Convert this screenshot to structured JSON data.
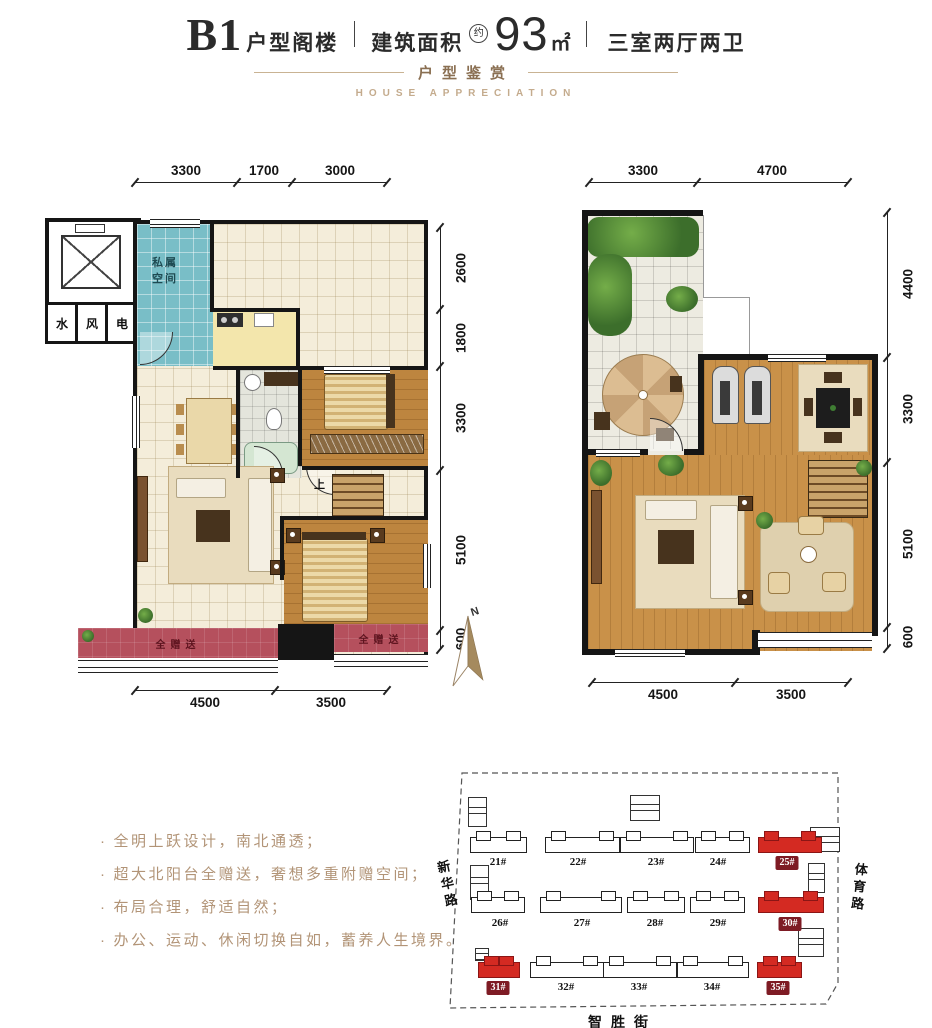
{
  "header": {
    "model": "B1",
    "model_suffix": "户型阁楼",
    "sep": "|",
    "area_label": "建筑面积",
    "approx": "约",
    "area_value": "93",
    "area_unit": "㎡",
    "rooms": "三室两厅两卫"
  },
  "subtitle": {
    "cn": "户型鉴赏",
    "en": "HOUSE APPRECIATION"
  },
  "bullet": "·",
  "selling_points": [
    "全明上跃设计，南北通透；",
    "超大北阳台全赠送，奢想多重附赠空间；",
    "布局合理，舒适自然；",
    "办公、运动、休闲切换自如，蓄养人生境界。"
  ],
  "lower_plan": {
    "dims_top": [
      "3300",
      "1700",
      "3000"
    ],
    "dims_right": [
      "2600",
      "1800",
      "3300",
      "5100",
      "600"
    ],
    "dims_bottom": [
      "4500",
      "3500"
    ],
    "room_private": "私属空间",
    "shaft_water": "水",
    "shaft_wind": "风",
    "shaft_elec": "电",
    "balcony_left": "全赠送",
    "balcony_right": "全赠送",
    "stairs_up": "上"
  },
  "loft_plan": {
    "dims_top": [
      "3300",
      "4700"
    ],
    "dims_right": [
      "4400",
      "3300",
      "5100",
      "600"
    ],
    "dims_bottom": [
      "4500",
      "3500"
    ]
  },
  "compass": {
    "north": "N"
  },
  "site_map": {
    "street_left": "新华路",
    "street_right": "体育路",
    "street_bottom": "智胜街",
    "rows": [
      [
        {
          "label": "21#",
          "highlight": false
        },
        {
          "label": "22#",
          "highlight": false
        },
        {
          "label": "23#",
          "highlight": false
        },
        {
          "label": "24#",
          "highlight": false
        },
        {
          "label": "25#",
          "highlight": true
        }
      ],
      [
        {
          "label": "26#",
          "highlight": false
        },
        {
          "label": "27#",
          "highlight": false
        },
        {
          "label": "28#",
          "highlight": false
        },
        {
          "label": "29#",
          "highlight": false
        },
        {
          "label": "30#",
          "highlight": true
        }
      ],
      [
        {
          "label": "31#",
          "highlight": true
        },
        {
          "label": "32#",
          "highlight": false
        },
        {
          "label": "33#",
          "highlight": false
        },
        {
          "label": "34#",
          "highlight": false
        },
        {
          "label": "35#",
          "highlight": true
        }
      ]
    ]
  },
  "colors": {
    "accent_tan": "#b29477",
    "teal_room": "#79bec7",
    "wood_floor": "#c99149",
    "balcony_red": "#b5505d",
    "map_highlight_red": "#d42a22",
    "map_label_red": "#7e1b24"
  }
}
